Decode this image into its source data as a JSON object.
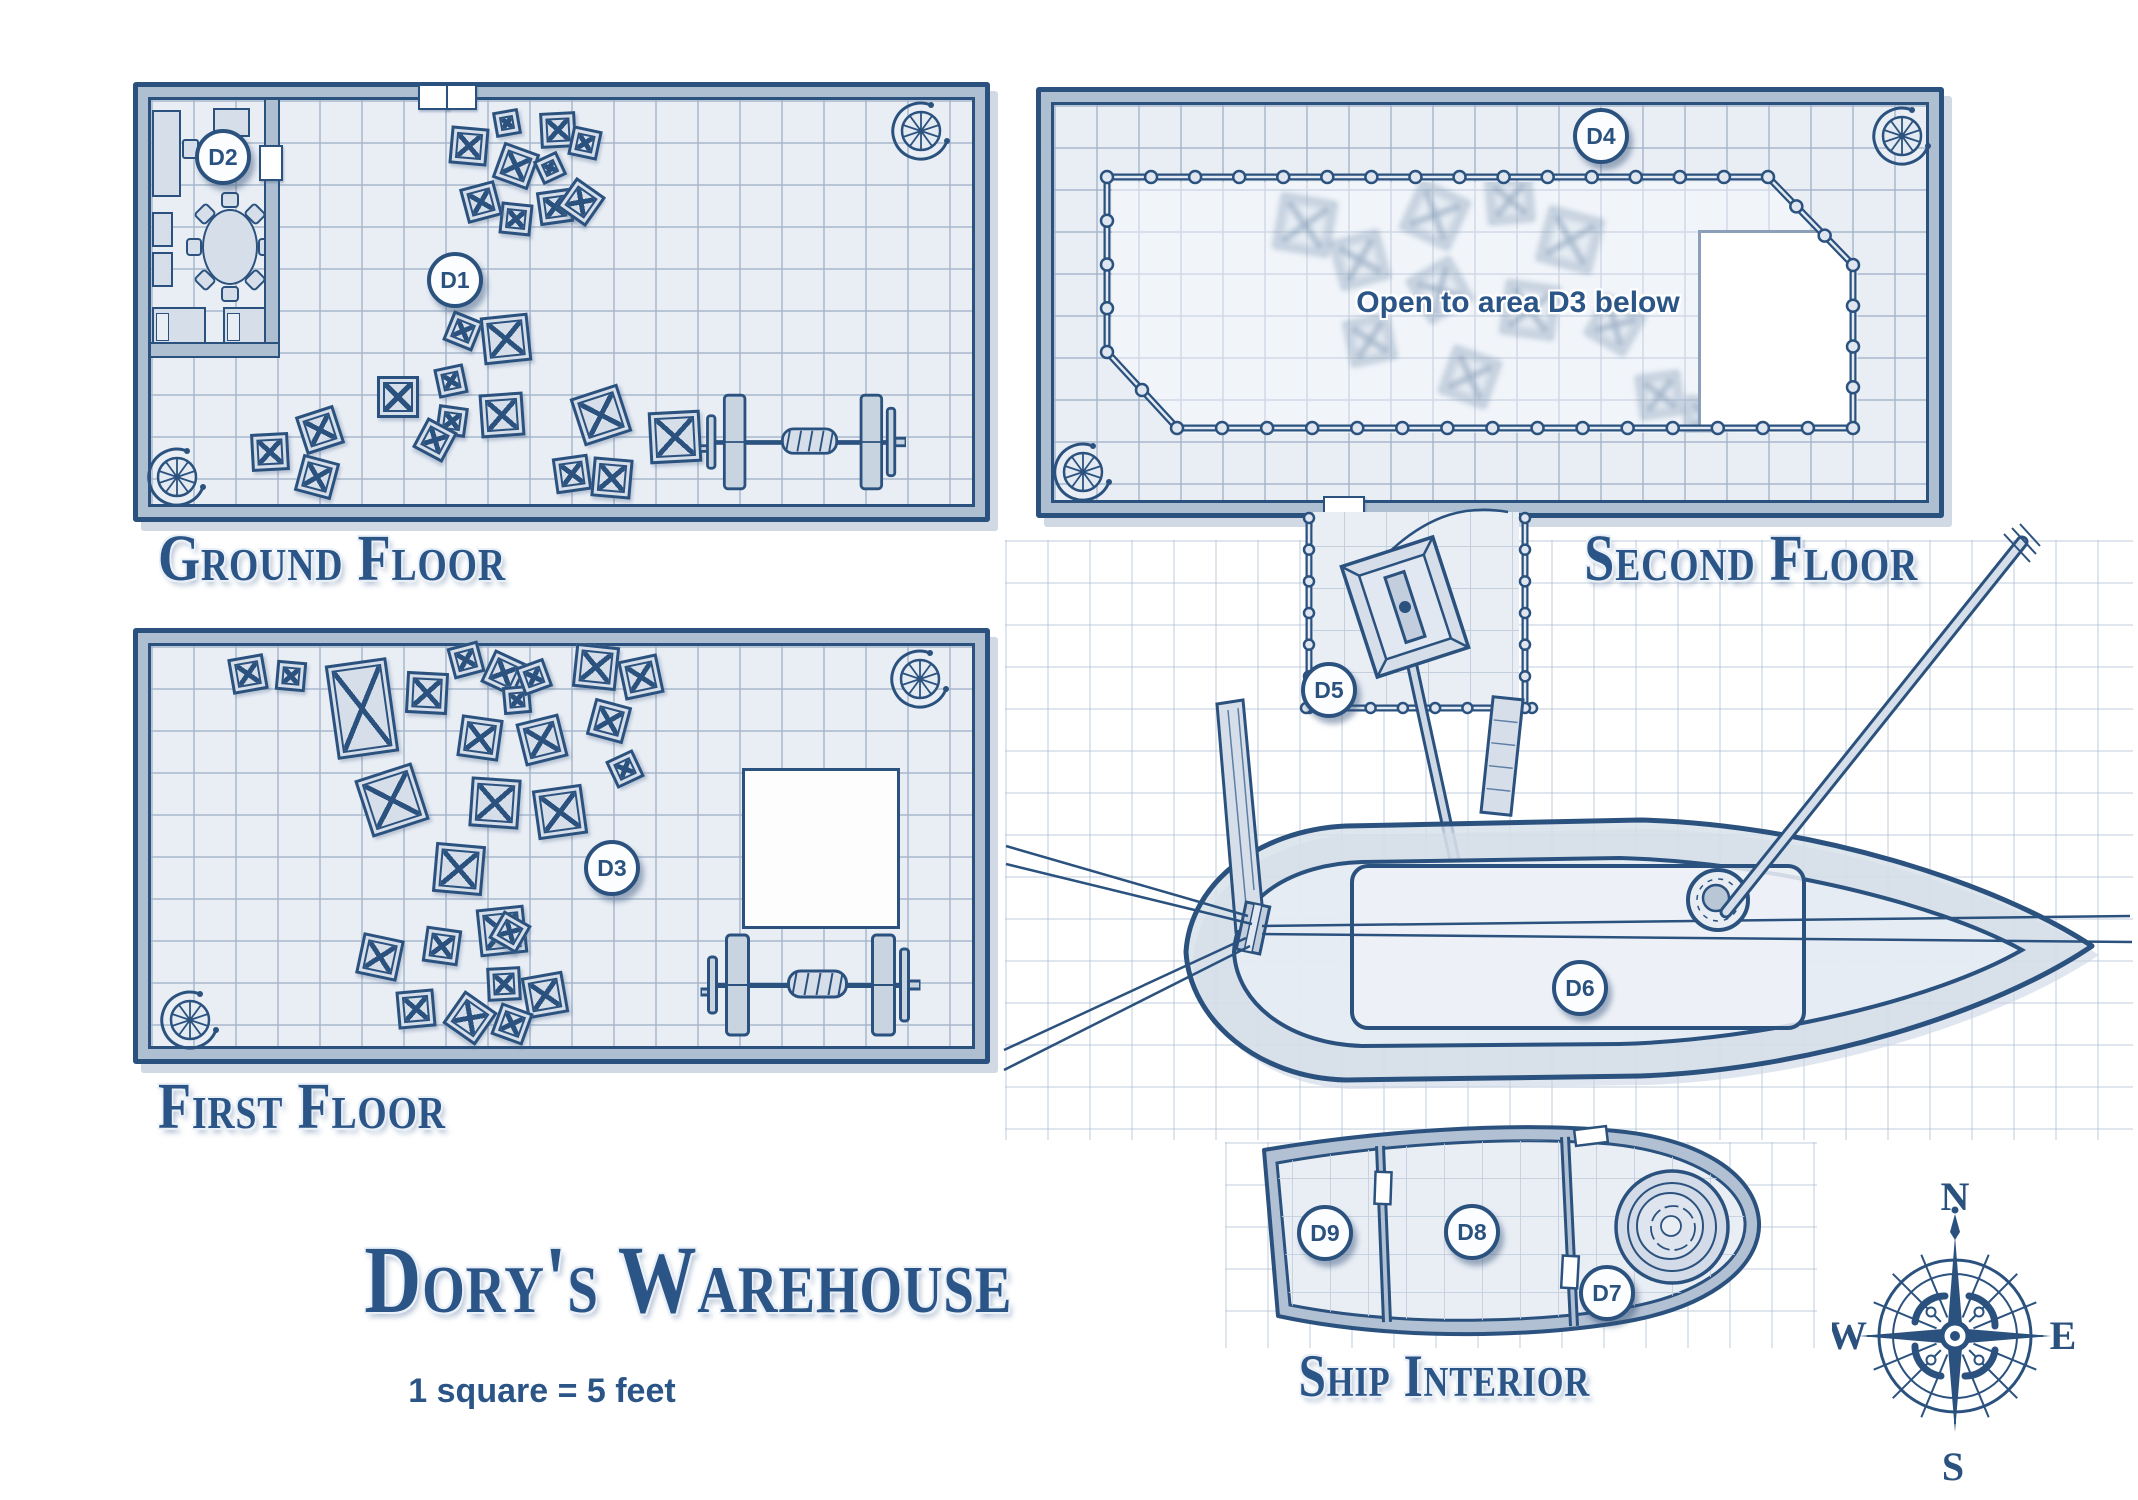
{
  "header": {
    "title": "Dory's Warehouse",
    "scale_note": "1 square = 5 feet"
  },
  "floor_plans": {
    "ground": {
      "label": "Ground Floor"
    },
    "first": {
      "label": "First Floor"
    },
    "second": {
      "label": "Second Floor"
    },
    "ship_interior": {
      "label": "Ship Interior"
    }
  },
  "annotations": {
    "second_floor_opening": "Open to area D3 below"
  },
  "area_markers": [
    {
      "id": "D1",
      "x": 455,
      "y": 280
    },
    {
      "id": "D2",
      "x": 223,
      "y": 157
    },
    {
      "id": "D3",
      "x": 612,
      "y": 868
    },
    {
      "id": "D4",
      "x": 1601,
      "y": 136
    },
    {
      "id": "D5",
      "x": 1329,
      "y": 690
    },
    {
      "id": "D6",
      "x": 1580,
      "y": 988
    },
    {
      "id": "D7",
      "x": 1607,
      "y": 1293
    },
    {
      "id": "D8",
      "x": 1472,
      "y": 1232
    },
    {
      "id": "D9",
      "x": 1325,
      "y": 1233
    }
  ],
  "compass": {
    "north": "N",
    "east": "E",
    "south": "S",
    "west": "W"
  },
  "colors": {
    "ink": "#2b527e",
    "wall_fill": "#aebfd2",
    "floor_fill": "#e9eef5",
    "grid_line": "#c4cfde",
    "crate_fill": "#d6dee9",
    "label_text": "#2c5587",
    "paper": "#ffffff"
  },
  "map_items": {
    "crates_ground": [
      [
        469,
        146,
        38,
        5
      ],
      [
        507,
        123,
        26,
        -10
      ],
      [
        558,
        130,
        36,
        -3
      ],
      [
        516,
        166,
        38,
        20
      ],
      [
        550,
        168,
        26,
        -25
      ],
      [
        585,
        143,
        30,
        12
      ],
      [
        555,
        207,
        34,
        -8
      ],
      [
        516,
        219,
        32,
        6
      ],
      [
        581,
        202,
        36,
        35
      ],
      [
        481,
        202,
        36,
        -15
      ],
      [
        463,
        331,
        32,
        22
      ],
      [
        506,
        339,
        48,
        -6
      ],
      [
        398,
        397,
        42,
        0
      ],
      [
        451,
        381,
        30,
        -12
      ],
      [
        452,
        421,
        30,
        8
      ],
      [
        502,
        415,
        44,
        -4
      ],
      [
        601,
        415,
        50,
        -18
      ],
      [
        675,
        437,
        52,
        -3
      ],
      [
        572,
        474,
        36,
        -8
      ],
      [
        612,
        478,
        40,
        5
      ],
      [
        320,
        430,
        40,
        -18
      ],
      [
        270,
        452,
        38,
        -3
      ],
      [
        317,
        477,
        38,
        15
      ],
      [
        435,
        440,
        34,
        28
      ]
    ],
    "crates_first": [
      [
        248,
        674,
        36,
        -10
      ],
      [
        291,
        676,
        30,
        5
      ],
      [
        362,
        708,
        62,
        -8,
        95
      ],
      [
        427,
        693,
        42,
        3
      ],
      [
        466,
        660,
        32,
        -15
      ],
      [
        504,
        673,
        36,
        25
      ],
      [
        517,
        700,
        28,
        -5
      ],
      [
        534,
        677,
        30,
        -20
      ],
      [
        596,
        667,
        44,
        6
      ],
      [
        641,
        677,
        40,
        -12
      ],
      [
        480,
        738,
        42,
        8
      ],
      [
        542,
        740,
        44,
        -14
      ],
      [
        609,
        721,
        38,
        15
      ],
      [
        625,
        769,
        30,
        -25
      ],
      [
        392,
        800,
        60,
        -18
      ],
      [
        495,
        803,
        50,
        4
      ],
      [
        560,
        812,
        50,
        -8
      ],
      [
        459,
        869,
        50,
        5
      ],
      [
        502,
        931,
        48,
        -6
      ],
      [
        510,
        932,
        32,
        30
      ],
      [
        442,
        946,
        36,
        8
      ],
      [
        380,
        957,
        42,
        12
      ],
      [
        416,
        1009,
        38,
        -5
      ],
      [
        470,
        1018,
        40,
        35
      ],
      [
        504,
        984,
        34,
        -3
      ],
      [
        545,
        995,
        42,
        -10
      ],
      [
        512,
        1024,
        34,
        20
      ]
    ],
    "ghost_crates_second": [
      [
        1300,
        220,
        56,
        10
      ],
      [
        1355,
        255,
        50,
        -15
      ],
      [
        1430,
        210,
        54,
        25
      ],
      [
        1505,
        195,
        46,
        -5
      ],
      [
        1565,
        235,
        56,
        15
      ],
      [
        1435,
        285,
        50,
        -30
      ],
      [
        1525,
        305,
        54,
        8
      ],
      [
        1365,
        335,
        46,
        -12
      ],
      [
        1465,
        372,
        50,
        20
      ],
      [
        1610,
        320,
        46,
        30
      ],
      [
        1655,
        390,
        44,
        -8
      ],
      [
        1700,
        412,
        40,
        4
      ]
    ]
  }
}
